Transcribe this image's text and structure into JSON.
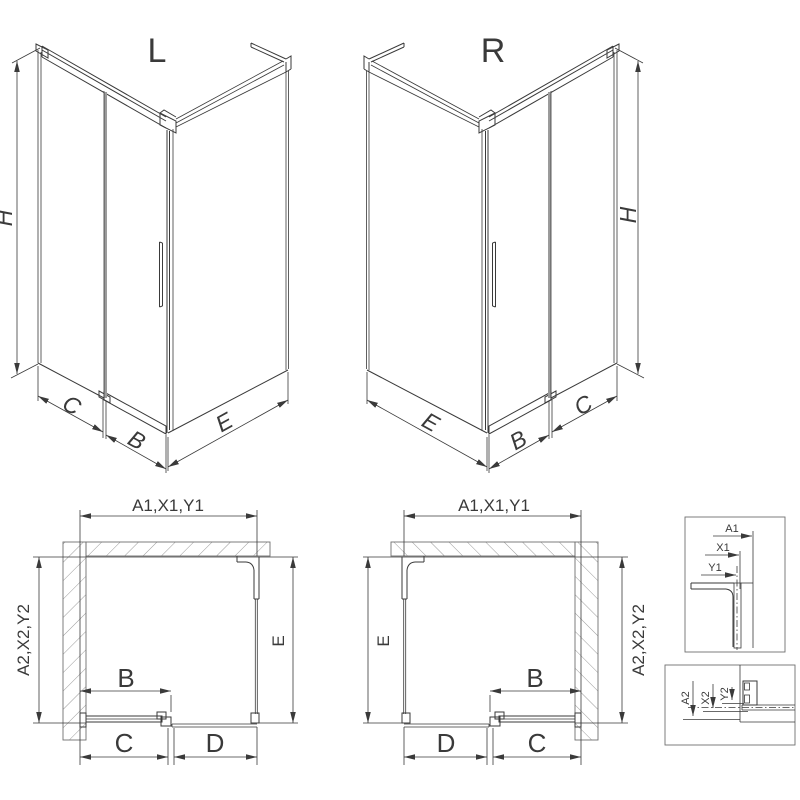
{
  "colors": {
    "line": "#3a3a3a",
    "wall": "#6f6f6f",
    "hatch": "#8f8f8f",
    "gray": "#9b9b9b",
    "bg": "#ffffff"
  },
  "iso_left": {
    "title": "L",
    "dim_height": "H",
    "dim_side": "C",
    "dim_door": "B",
    "dim_panel": "E"
  },
  "iso_right": {
    "title": "R",
    "dim_height": "H",
    "dim_side": "C",
    "dim_door": "B",
    "dim_panel": "E"
  },
  "plan_left": {
    "dim_top": "A1,X1,Y1",
    "dim_left": "A2,X2,Y2",
    "dim_door": "B",
    "dim_bottom_left": "C",
    "dim_bottom_right": "D",
    "dim_right": "E"
  },
  "plan_right": {
    "dim_top": "A1,X1,Y1",
    "dim_right": "A2,X2,Y2",
    "dim_door": "B",
    "dim_bottom_left": "D",
    "dim_bottom_right": "C",
    "dim_left": "E"
  },
  "detail_top": {
    "dim_a": "A1",
    "dim_x": "X1",
    "dim_y": "Y1"
  },
  "detail_bottom": {
    "dim_a": "A2",
    "dim_x": "X2",
    "dim_y": "Y2"
  }
}
